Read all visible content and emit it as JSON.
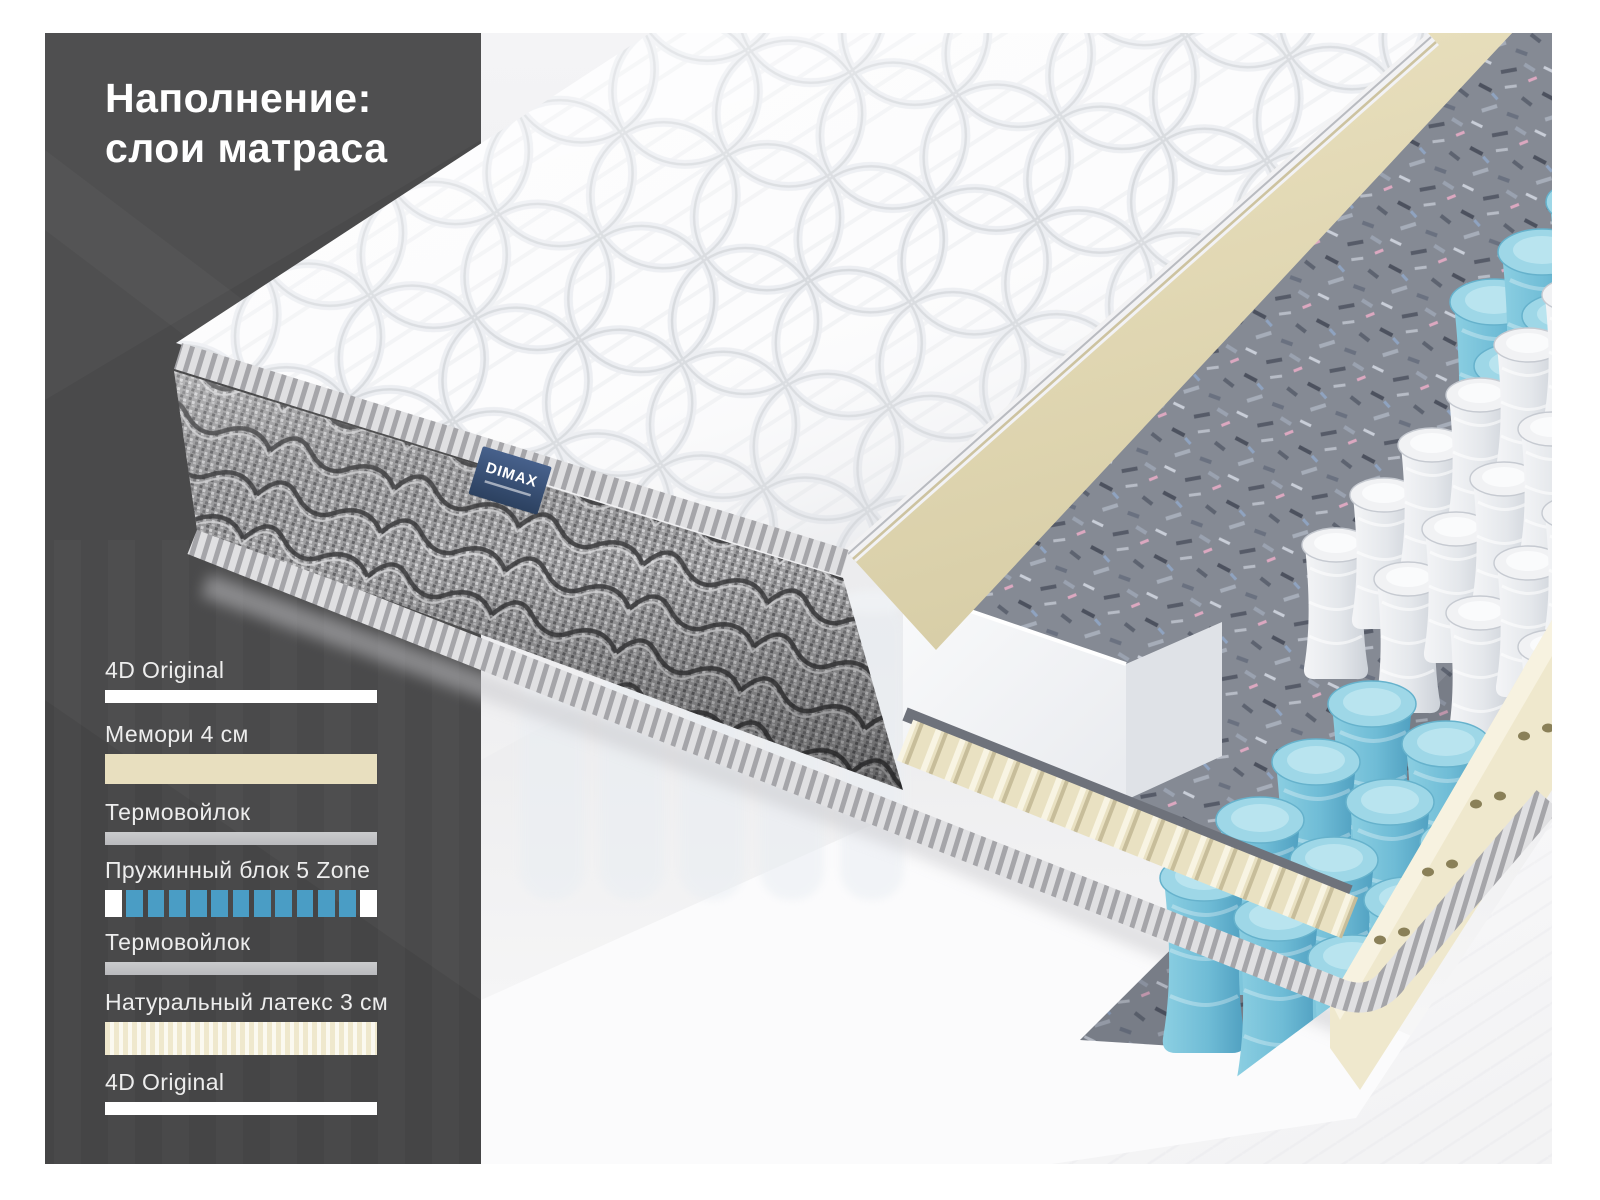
{
  "title": {
    "line1": "Наполнение:",
    "line2": "слои матраса"
  },
  "brand": {
    "name": "DIMAX"
  },
  "legend": {
    "items": [
      {
        "label": "4D Original",
        "material": "fabric-top"
      },
      {
        "label": "Мемори 4 см",
        "material": "memory-foam"
      },
      {
        "label": "Термовойлок",
        "material": "thermo-felt"
      },
      {
        "label": "Пружинный блок 5 Zone",
        "material": "spring-block"
      },
      {
        "label": "Термовойлок",
        "material": "thermo-felt"
      },
      {
        "label": "Натуральный латекс 3 см",
        "material": "natural-latex"
      },
      {
        "label": "4D Original",
        "material": "fabric-bottom"
      }
    ]
  },
  "spring_block_bar": {
    "total_cells": 13,
    "blue_cells": 11,
    "white_end_cells": 2
  },
  "colors": {
    "panel": "#4a4a4b",
    "title_text": "#ffffff",
    "label_text": "#ededed",
    "fabric_white": "#ffffff",
    "memory_beige": "#e8dfbf",
    "felt_gray": "#b9babd",
    "spring_blue": "#4a9dc5",
    "latex_cream": "#efe8cd",
    "label_blue": "#3b5272"
  }
}
